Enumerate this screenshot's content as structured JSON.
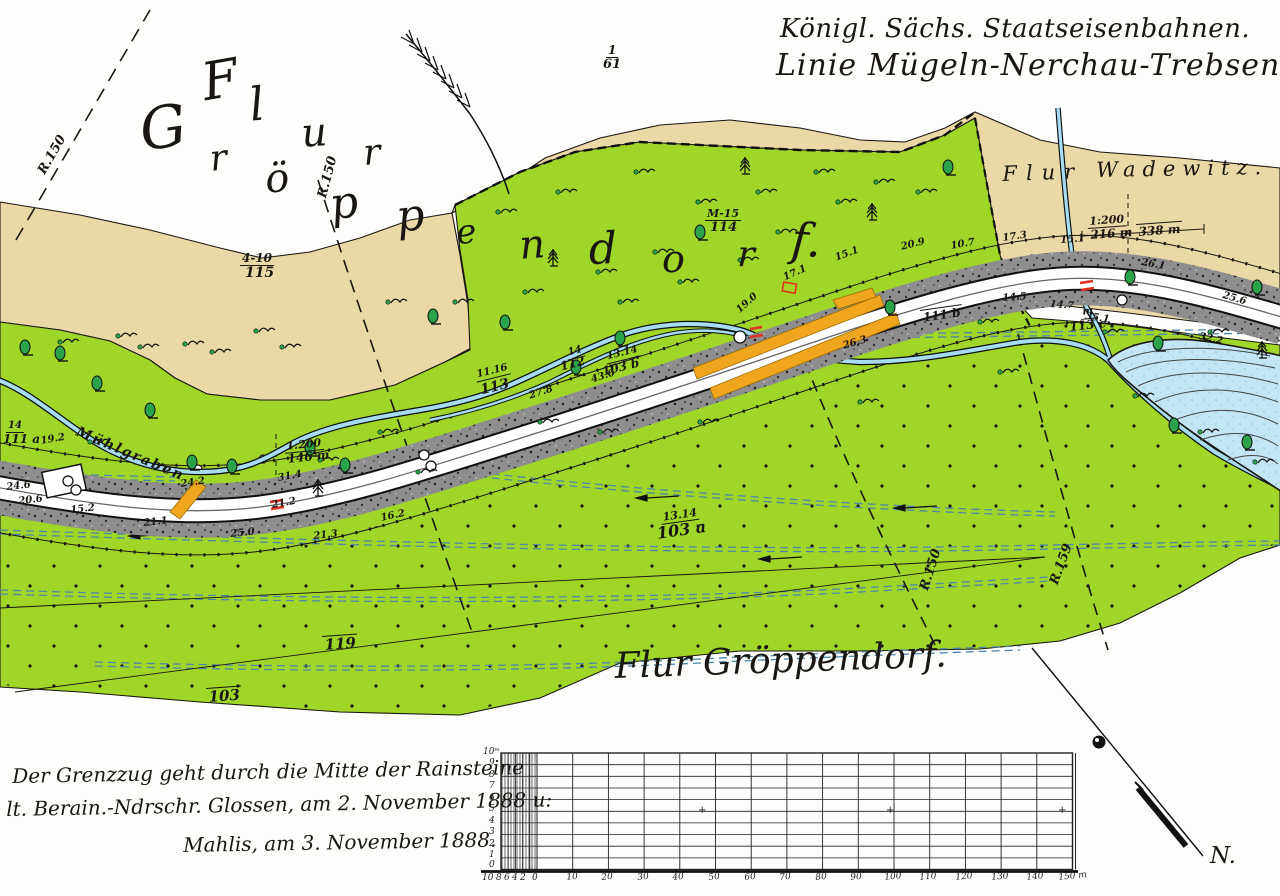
{
  "header": {
    "line1": "Königl. Sächs. Staatseisenbahnen.",
    "line2": "Linie Mügeln-Nerchau-Trebsen."
  },
  "map": {
    "wadewitz_flur": "Flur",
    "wadewitz_name": "Wadewitz.",
    "stream_name": "Mühlgraben",
    "bottom_title": "Flur Gröppendorf."
  },
  "notes": {
    "line1": "Der Grenzzug geht durch die Mitte der Rainsteine",
    "line2": "lt. Berain.-Ndrschr. Glossen, am 2. November 1888 u:",
    "line3": "Mahlis, am 3. November 1888."
  },
  "compass": {
    "label": "N."
  },
  "colors": {
    "tan": "#ead8a6",
    "green": "#a0d628",
    "water": "#a8dcf0",
    "pond": "#c2e6f5",
    "rail": "#8e8e8e",
    "orange": "#f0a51e",
    "red": "#e03020",
    "tree": "#2aa34a",
    "ditch": "#4d88aa",
    "ink": "#1a1612"
  },
  "positioned": [
    {
      "t": "F",
      "x": 198,
      "y": 58,
      "s": 52,
      "r": -10,
      "c": "letter"
    },
    {
      "t": "l",
      "x": 247,
      "y": 82,
      "s": 46,
      "r": -6,
      "c": "letter"
    },
    {
      "t": "u",
      "x": 300,
      "y": 114,
      "s": 40,
      "r": -4,
      "c": "letter"
    },
    {
      "t": "r",
      "x": 362,
      "y": 136,
      "s": 36,
      "r": -4,
      "c": "letter"
    },
    {
      "t": "G",
      "x": 136,
      "y": 102,
      "s": 58,
      "r": -8,
      "c": "letter"
    },
    {
      "t": "r",
      "x": 208,
      "y": 142,
      "s": 36,
      "r": -6,
      "c": "letter"
    },
    {
      "t": "ö",
      "x": 263,
      "y": 160,
      "s": 40,
      "r": -6,
      "c": "letter"
    },
    {
      "t": "p",
      "x": 327,
      "y": 184,
      "s": 44,
      "r": -8,
      "c": "letter"
    },
    {
      "t": "p",
      "x": 394,
      "y": 196,
      "s": 44,
      "r": -6,
      "c": "letter"
    },
    {
      "t": "e",
      "x": 455,
      "y": 216,
      "s": 34,
      "r": -4,
      "c": "letter"
    },
    {
      "t": "n",
      "x": 518,
      "y": 226,
      "s": 40,
      "r": -4,
      "c": "letter"
    },
    {
      "t": "d",
      "x": 588,
      "y": 228,
      "s": 44,
      "r": -2,
      "c": "letter"
    },
    {
      "t": "o",
      "x": 662,
      "y": 240,
      "s": 38,
      "r": 0,
      "c": "letter"
    },
    {
      "t": "r",
      "x": 738,
      "y": 237,
      "s": 36,
      "r": 2,
      "c": "letter"
    },
    {
      "t": "f.",
      "x": 793,
      "y": 216,
      "s": 46,
      "r": 4,
      "c": "letter"
    },
    {
      "t": "R.150",
      "x": 36,
      "y": 170,
      "r": -60,
      "s": 13,
      "c": "meas"
    },
    {
      "t": "R.150",
      "x": 316,
      "y": 196,
      "r": -75,
      "s": 13,
      "c": "meas"
    },
    {
      "t": "R.150",
      "x": 918,
      "y": 588,
      "r": -72,
      "s": 13,
      "c": "meas"
    },
    {
      "t": "R.159",
      "x": 1048,
      "y": 582,
      "r": -70,
      "s": 13,
      "c": "meas"
    },
    {
      "t": "17.3",
      "x": 1002,
      "y": 234,
      "r": -8,
      "c": "meas"
    },
    {
      "t": "15.1",
      "x": 1060,
      "y": 236,
      "r": -4,
      "c": "meas"
    },
    {
      "t": "26.1",
      "x": 1142,
      "y": 258,
      "r": 10,
      "c": "meas"
    },
    {
      "t": "25.6",
      "x": 1224,
      "y": 291,
      "r": 16,
      "c": "meas"
    },
    {
      "t": "14.5",
      "x": 1002,
      "y": 294,
      "r": -4,
      "c": "meas"
    },
    {
      "t": "14.7",
      "x": 1050,
      "y": 300,
      "r": 4,
      "c": "meas"
    },
    {
      "t": "35.1",
      "x": 1086,
      "y": 312,
      "r": 8,
      "c": "meas"
    },
    {
      "t": "32.2",
      "x": 1200,
      "y": 332,
      "r": 12,
      "c": "meas"
    },
    {
      "t": "20.9",
      "x": 900,
      "y": 243,
      "r": -14,
      "c": "meas"
    },
    {
      "t": "10.7",
      "x": 950,
      "y": 242,
      "r": -10,
      "c": "meas"
    },
    {
      "t": "17.1",
      "x": 782,
      "y": 274,
      "r": -24,
      "c": "meas"
    },
    {
      "t": "15.1",
      "x": 834,
      "y": 254,
      "r": -20,
      "c": "meas"
    },
    {
      "t": "19.0",
      "x": 735,
      "y": 308,
      "r": -42,
      "c": "meas"
    },
    {
      "t": "26.3",
      "x": 842,
      "y": 342,
      "r": -16,
      "c": "meas"
    },
    {
      "t": "27.8",
      "x": 528,
      "y": 392,
      "r": -18,
      "c": "meas"
    },
    {
      "t": "43.6",
      "x": 590,
      "y": 376,
      "r": -18,
      "c": "meas"
    },
    {
      "t": "19.2",
      "x": 40,
      "y": 437,
      "r": -10,
      "c": "meas"
    },
    {
      "t": "24.6",
      "x": 6,
      "y": 483,
      "r": -6,
      "c": "meas"
    },
    {
      "t": "20.6",
      "x": 18,
      "y": 497,
      "r": -6,
      "c": "meas"
    },
    {
      "t": "15.2",
      "x": 70,
      "y": 506,
      "r": -6,
      "c": "meas"
    },
    {
      "t": "21.1",
      "x": 143,
      "y": 519,
      "r": -6,
      "c": "meas"
    },
    {
      "t": "24.2",
      "x": 180,
      "y": 480,
      "r": -8,
      "c": "meas"
    },
    {
      "t": "31.4",
      "x": 277,
      "y": 474,
      "r": -10,
      "c": "meas"
    },
    {
      "t": "21.2",
      "x": 271,
      "y": 501,
      "r": -10,
      "c": "meas"
    },
    {
      "t": "25.0",
      "x": 230,
      "y": 530,
      "r": -6,
      "c": "meas"
    },
    {
      "t": "21.3",
      "x": 313,
      "y": 532,
      "r": -6,
      "c": "meas"
    },
    {
      "t": "16.2",
      "x": 380,
      "y": 514,
      "r": -12,
      "c": "meas"
    },
    {
      "t": "1:200",
      "x": 284,
      "y": 441,
      "r": -6,
      "c": "fractop"
    },
    {
      "t": "146 m",
      "x": 286,
      "y": 453,
      "r": -6,
      "c": "fracbot"
    },
    {
      "t": "1:200",
      "x": 1087,
      "y": 216,
      "r": -4,
      "c": "fractop"
    },
    {
      "t": "216 m",
      "x": 1089,
      "y": 229,
      "r": -4,
      "c": "fracbot"
    },
    {
      "t": "338 m",
      "x": 1136,
      "y": 224,
      "r": -4,
      "c": "overline"
    },
    {
      "t": "1",
      "x": 606,
      "y": 44,
      "s": 12,
      "c": "fractop"
    },
    {
      "t": "61",
      "x": 602,
      "y": 58,
      "s": 13,
      "c": "fracbot"
    },
    {
      "t": "4-10",
      "x": 240,
      "y": 252,
      "s": 12,
      "c": "fractop"
    },
    {
      "t": "115",
      "x": 244,
      "y": 266,
      "s": 14,
      "c": "fracbot"
    },
    {
      "t": "M-15",
      "x": 705,
      "y": 208,
      "s": 11,
      "c": "fractop"
    },
    {
      "t": "114",
      "x": 709,
      "y": 221,
      "s": 13,
      "c": "fracbot"
    },
    {
      "t": "11.16",
      "x": 474,
      "y": 371,
      "r": -14,
      "s": 10,
      "c": "fractop"
    },
    {
      "t": "113",
      "x": 478,
      "y": 384,
      "r": -14,
      "s": 14,
      "c": "fracbot"
    },
    {
      "t": "14",
      "x": 565,
      "y": 349,
      "r": -14,
      "s": 10,
      "c": "fractop"
    },
    {
      "t": "112",
      "x": 558,
      "y": 361,
      "r": -14,
      "s": 12,
      "c": "fracbot"
    },
    {
      "t": "13.14",
      "x": 604,
      "y": 353,
      "r": -14,
      "s": 10,
      "c": "fractop"
    },
    {
      "t": "103 b",
      "x": 600,
      "y": 366,
      "r": -14,
      "s": 12,
      "c": "fracbot"
    },
    {
      "t": "13.14",
      "x": 660,
      "y": 512,
      "r": -8,
      "s": 11,
      "c": "fractop"
    },
    {
      "t": "103 a",
      "x": 655,
      "y": 526,
      "r": -8,
      "s": 16,
      "c": "fracbot"
    },
    {
      "t": "14",
      "x": 6,
      "y": 421,
      "s": 10,
      "c": "fractop"
    },
    {
      "t": "111 a",
      "x": 2,
      "y": 433,
      "s": 12,
      "c": "fracbot"
    },
    {
      "t": "m",
      "x": 1080,
      "y": 308,
      "r": -6,
      "s": 10,
      "c": "fractop"
    },
    {
      "t": "113 c",
      "x": 1068,
      "y": 321,
      "r": -6,
      "s": 12,
      "c": "fracbot"
    },
    {
      "t": "111 b",
      "x": 920,
      "y": 310,
      "r": -8,
      "c": "overline"
    },
    {
      "t": "119",
      "x": 322,
      "y": 636,
      "r": -4,
      "s": 15,
      "c": "overline"
    },
    {
      "t": "103",
      "x": 206,
      "y": 688,
      "r": -4,
      "s": 15,
      "c": "overline"
    },
    {
      "t": "10",
      "x": 482,
      "y": 874,
      "c": "tick"
    },
    {
      "t": "8",
      "x": 496,
      "y": 874,
      "c": "tick"
    },
    {
      "t": "6",
      "x": 504,
      "y": 874,
      "c": "tick"
    },
    {
      "t": "4",
      "x": 512,
      "y": 874,
      "c": "tick"
    },
    {
      "t": "2",
      "x": 520,
      "y": 874,
      "c": "tick"
    },
    {
      "t": "0",
      "x": 532,
      "y": 874,
      "c": "tick"
    },
    {
      "t": "10",
      "x": 566,
      "y": 874,
      "r": -6,
      "c": "tick"
    },
    {
      "t": "20",
      "x": 601,
      "y": 874,
      "r": -6,
      "c": "tick"
    },
    {
      "t": "30",
      "x": 637,
      "y": 874,
      "r": -6,
      "c": "tick"
    },
    {
      "t": "40",
      "x": 672,
      "y": 874,
      "r": -6,
      "c": "tick"
    },
    {
      "t": "50",
      "x": 708,
      "y": 874,
      "r": -6,
      "c": "tick"
    },
    {
      "t": "60",
      "x": 744,
      "y": 874,
      "r": -6,
      "c": "tick"
    },
    {
      "t": "70",
      "x": 779,
      "y": 874,
      "r": -6,
      "c": "tick"
    },
    {
      "t": "80",
      "x": 815,
      "y": 874,
      "r": -6,
      "c": "tick"
    },
    {
      "t": "90",
      "x": 850,
      "y": 874,
      "r": -6,
      "c": "tick"
    },
    {
      "t": "100",
      "x": 884,
      "y": 874,
      "r": -6,
      "c": "tick"
    },
    {
      "t": "110",
      "x": 919,
      "y": 874,
      "r": -6,
      "c": "tick"
    },
    {
      "t": "120",
      "x": 955,
      "y": 874,
      "r": -6,
      "c": "tick"
    },
    {
      "t": "130",
      "x": 991,
      "y": 874,
      "r": -6,
      "c": "tick"
    },
    {
      "t": "140",
      "x": 1026,
      "y": 874,
      "r": -6,
      "c": "tick"
    },
    {
      "t": "150 m",
      "x": 1058,
      "y": 874,
      "r": -6,
      "c": "tick"
    },
    {
      "t": "10ᵐ",
      "x": 483,
      "y": 748,
      "c": "tick"
    },
    {
      "t": "9",
      "x": 489,
      "y": 759,
      "c": "tick"
    },
    {
      "t": "8",
      "x": 489,
      "y": 771,
      "c": "tick"
    },
    {
      "t": "7",
      "x": 489,
      "y": 782,
      "c": "tick"
    },
    {
      "t": "6",
      "x": 489,
      "y": 794,
      "c": "tick"
    },
    {
      "t": "5",
      "x": 489,
      "y": 805,
      "c": "tick"
    },
    {
      "t": "4",
      "x": 489,
      "y": 817,
      "c": "tick"
    },
    {
      "t": "3",
      "x": 489,
      "y": 828,
      "c": "tick"
    },
    {
      "t": "2",
      "x": 489,
      "y": 840,
      "c": "tick"
    },
    {
      "t": "1",
      "x": 489,
      "y": 851,
      "c": "tick"
    },
    {
      "t": "0",
      "x": 489,
      "y": 861,
      "c": "tick"
    },
    {
      "t": "+",
      "x": 698,
      "y": 806,
      "c": "plus"
    },
    {
      "t": "+",
      "x": 886,
      "y": 806,
      "c": "plus"
    },
    {
      "t": "+",
      "x": 1058,
      "y": 806,
      "c": "plus"
    }
  ]
}
